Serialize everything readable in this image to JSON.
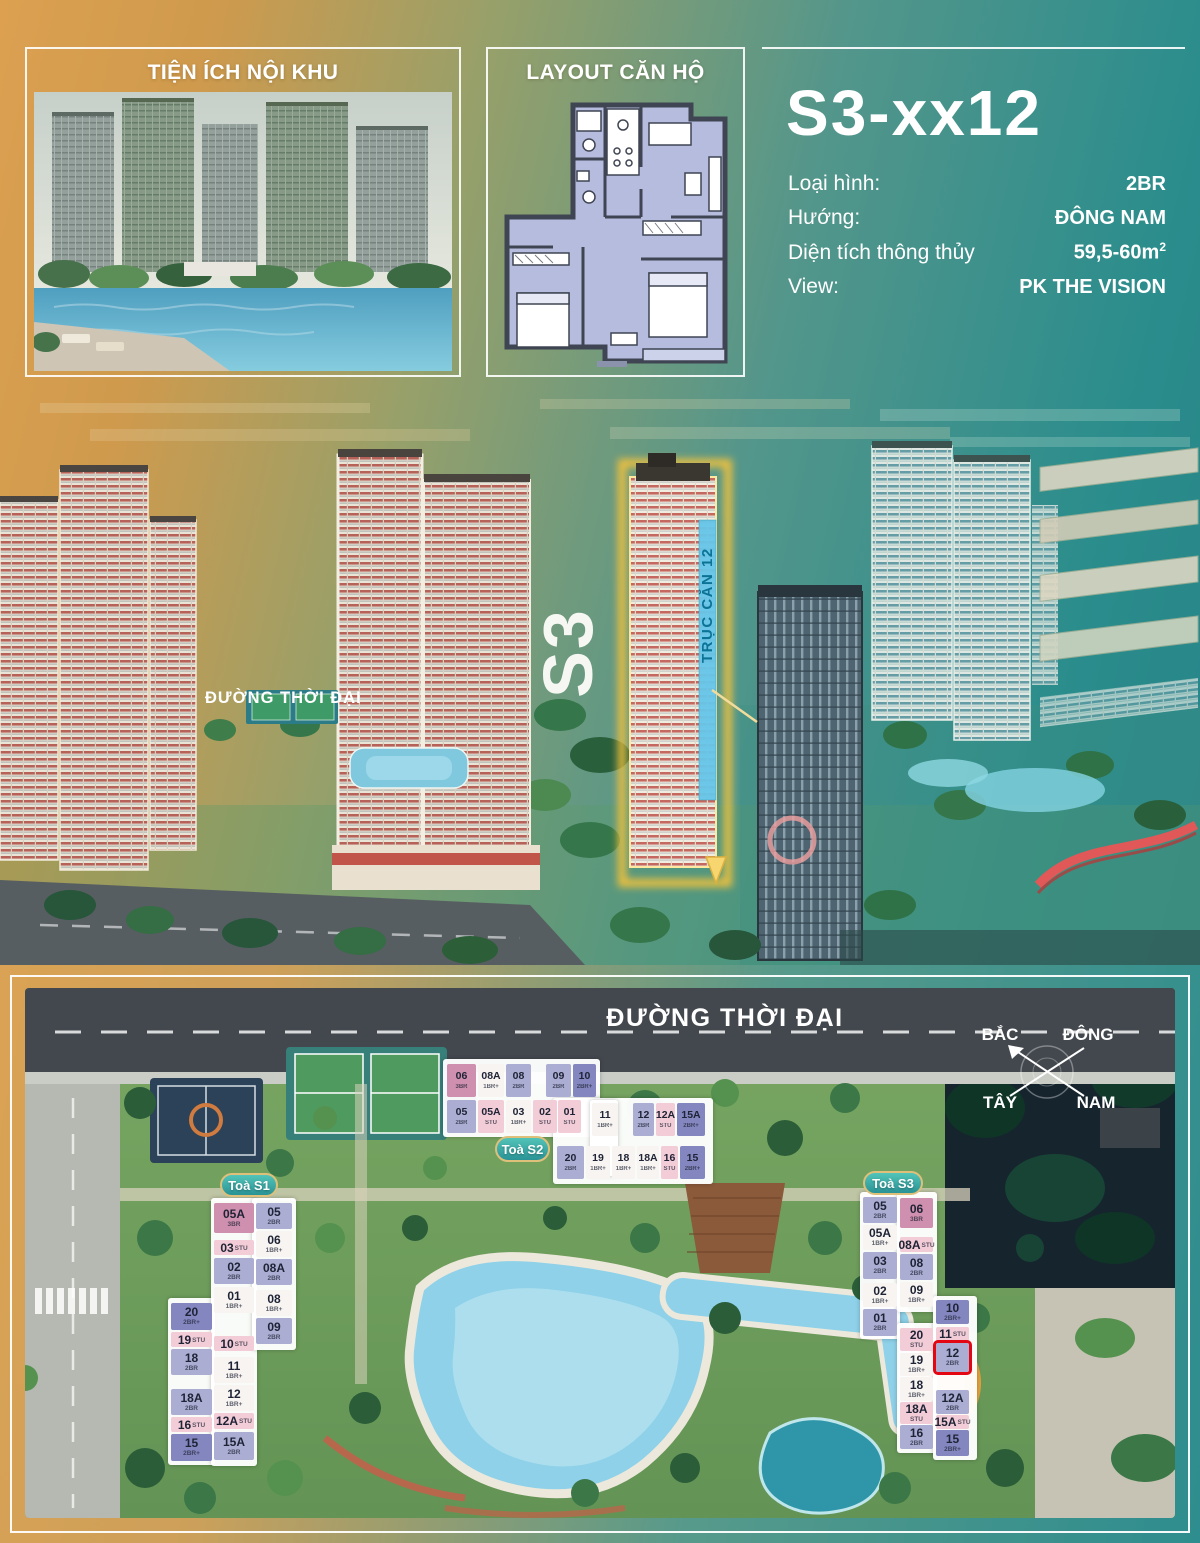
{
  "panels": {
    "amenities": {
      "title": "TIỆN ÍCH NỘI KHU"
    },
    "layout": {
      "title": "LAYOUT CĂN HỘ"
    },
    "unit": {
      "code": "S3-xx12",
      "specs": [
        {
          "label": "Loại hình:",
          "value": "2BR"
        },
        {
          "label": "Hướng:",
          "value": "ĐÔNG NAM"
        },
        {
          "label": "Diện tích thông thủy",
          "value": "59,5-60m",
          "sup": "2"
        },
        {
          "label": "View:",
          "value": "PK THE VISION"
        }
      ]
    }
  },
  "aerial": {
    "street_label": "ĐƯỜNG THỜI ĐẠI",
    "tower_label": "S3",
    "axis_label": "TRỤC CĂN 12"
  },
  "sitemap": {
    "street_label": "ĐƯỜNG THỜI ĐẠI",
    "compass": {
      "north": "BẮC",
      "east": "ĐÔNG",
      "west": "TÂY",
      "south": "NAM"
    },
    "highlight_unit": "S3-12",
    "legend_types": [
      "STU",
      "1BR+",
      "2BR",
      "2BR+",
      "3BR"
    ],
    "towers": [
      {
        "id": "S1",
        "label": "Toà S1",
        "pill": {
          "x": 195,
          "y": 185,
          "w": 58,
          "h": 24
        },
        "blocks": [
          [
            143,
            310,
            47,
            167
          ],
          [
            186,
            210,
            46,
            268
          ],
          [
            227,
            210,
            44,
            152
          ]
        ],
        "units": [
          {
            "n": "20",
            "t": "2BR+",
            "c": "bp",
            "x": 146,
            "y": 315,
            "w": 41,
            "h": 27
          },
          {
            "n": "19",
            "t": "STU",
            "c": "st",
            "x": 146,
            "y": 344,
            "w": 41,
            "h": 15,
            "s": 1
          },
          {
            "n": "18",
            "t": "2BR",
            "c": "b2",
            "x": 146,
            "y": 361,
            "w": 41,
            "h": 26
          },
          {
            "n": "18A",
            "t": "2BR",
            "c": "b2",
            "x": 146,
            "y": 401,
            "w": 41,
            "h": 26
          },
          {
            "n": "16",
            "t": "STU",
            "c": "st",
            "x": 146,
            "y": 429,
            "w": 41,
            "h": 15,
            "s": 1
          },
          {
            "n": "15",
            "t": "2BR+",
            "c": "bp",
            "x": 146,
            "y": 446,
            "w": 41,
            "h": 27
          },
          {
            "n": "05A",
            "t": "3BR",
            "c": "p3",
            "x": 189,
            "y": 215,
            "w": 40,
            "h": 30
          },
          {
            "n": "03",
            "t": "STU",
            "c": "st",
            "x": 189,
            "y": 252,
            "w": 40,
            "h": 15,
            "s": 1
          },
          {
            "n": "02",
            "t": "2BR",
            "c": "b2",
            "x": 189,
            "y": 270,
            "w": 40,
            "h": 26
          },
          {
            "n": "01",
            "t": "1BR+",
            "c": "b1",
            "x": 189,
            "y": 299,
            "w": 40,
            "h": 26
          },
          {
            "n": "10",
            "t": "STU",
            "c": "st",
            "x": 189,
            "y": 348,
            "w": 40,
            "h": 15,
            "s": 1
          },
          {
            "n": "11",
            "t": "1BR+",
            "c": "b1",
            "x": 189,
            "y": 369,
            "w": 40,
            "h": 26
          },
          {
            "n": "12",
            "t": "1BR+",
            "c": "b1",
            "x": 189,
            "y": 397,
            "w": 40,
            "h": 26
          },
          {
            "n": "12A",
            "t": "STU",
            "c": "st",
            "x": 189,
            "y": 425,
            "w": 40,
            "h": 16,
            "s": 1
          },
          {
            "n": "15A",
            "t": "2BR",
            "c": "b2",
            "x": 189,
            "y": 444,
            "w": 40,
            "h": 28
          },
          {
            "n": "05",
            "t": "2BR",
            "c": "b2",
            "x": 231,
            "y": 215,
            "w": 36,
            "h": 26
          },
          {
            "n": "06",
            "t": "1BR+",
            "c": "b1",
            "x": 231,
            "y": 243,
            "w": 36,
            "h": 26
          },
          {
            "n": "08A",
            "t": "2BR",
            "c": "b2",
            "x": 231,
            "y": 271,
            "w": 36,
            "h": 26
          },
          {
            "n": "08",
            "t": "1BR+",
            "c": "b1",
            "x": 231,
            "y": 302,
            "w": 36,
            "h": 26
          },
          {
            "n": "09",
            "t": "2BR",
            "c": "b2",
            "x": 231,
            "y": 330,
            "w": 36,
            "h": 26
          }
        ]
      },
      {
        "id": "S2",
        "label": "Toà S2",
        "pill": {
          "x": 470,
          "y": 148,
          "w": 55,
          "h": 26
        },
        "blocks": [
          [
            418,
            71,
            157,
            78
          ],
          [
            528,
            110,
            160,
            86
          ],
          [
            565,
            112,
            28,
            76
          ]
        ],
        "units": [
          {
            "n": "06",
            "t": "3BR",
            "c": "p3",
            "x": 422,
            "y": 76,
            "w": 29,
            "h": 33
          },
          {
            "n": "08A",
            "t": "1BR+",
            "c": "b1",
            "x": 453,
            "y": 76,
            "w": 26,
            "h": 33
          },
          {
            "n": "08",
            "t": "2BR",
            "c": "b2",
            "x": 481,
            "y": 76,
            "w": 25,
            "h": 33
          },
          {
            "n": "09",
            "t": "2BR",
            "c": "b2",
            "x": 521,
            "y": 76,
            "w": 25,
            "h": 33
          },
          {
            "n": "10",
            "t": "2BR+",
            "c": "bp",
            "x": 548,
            "y": 76,
            "w": 23,
            "h": 33
          },
          {
            "n": "05",
            "t": "2BR",
            "c": "b2",
            "x": 422,
            "y": 112,
            "w": 29,
            "h": 33
          },
          {
            "n": "05A",
            "t": "STU",
            "c": "st",
            "x": 453,
            "y": 112,
            "w": 26,
            "h": 33
          },
          {
            "n": "03",
            "t": "1BR+",
            "c": "b1",
            "x": 481,
            "y": 112,
            "w": 25,
            "h": 33
          },
          {
            "n": "02",
            "t": "STU",
            "c": "st",
            "x": 508,
            "y": 112,
            "w": 24,
            "h": 33
          },
          {
            "n": "01",
            "t": "STU",
            "c": "st",
            "x": 533,
            "y": 112,
            "w": 23,
            "h": 33
          },
          {
            "n": "11",
            "t": "1BR+",
            "c": "b1",
            "x": 567,
            "y": 115,
            "w": 26,
            "h": 33
          },
          {
            "n": "12",
            "t": "2BR",
            "c": "b2",
            "x": 608,
            "y": 115,
            "w": 21,
            "h": 33
          },
          {
            "n": "12A",
            "t": "STU",
            "c": "st",
            "x": 631,
            "y": 115,
            "w": 19,
            "h": 33
          },
          {
            "n": "15A",
            "t": "2BR+",
            "c": "bp",
            "x": 652,
            "y": 115,
            "w": 28,
            "h": 33
          },
          {
            "n": "20",
            "t": "2BR",
            "c": "b2",
            "x": 532,
            "y": 158,
            "w": 27,
            "h": 33
          },
          {
            "n": "19",
            "t": "1BR+",
            "c": "b1",
            "x": 561,
            "y": 158,
            "w": 24,
            "h": 33
          },
          {
            "n": "18",
            "t": "1BR+",
            "c": "b1",
            "x": 587,
            "y": 158,
            "w": 23,
            "h": 33
          },
          {
            "n": "18A",
            "t": "1BR+",
            "c": "b1",
            "x": 612,
            "y": 158,
            "w": 22,
            "h": 33
          },
          {
            "n": "16",
            "t": "STU",
            "c": "st",
            "x": 636,
            "y": 158,
            "w": 17,
            "h": 33
          },
          {
            "n": "15",
            "t": "2BR+",
            "c": "bp",
            "x": 655,
            "y": 158,
            "w": 25,
            "h": 33
          }
        ]
      },
      {
        "id": "S3",
        "label": "Toà S3",
        "pill": {
          "x": 838,
          "y": 183,
          "w": 60,
          "h": 24
        },
        "blocks": [
          [
            835,
            204,
            40,
            147
          ],
          [
            872,
            204,
            40,
            120
          ],
          [
            872,
            335,
            40,
            130
          ],
          [
            908,
            308,
            44,
            164
          ]
        ],
        "units": [
          {
            "n": "05",
            "t": "2BR",
            "c": "b2",
            "x": 838,
            "y": 209,
            "w": 34,
            "h": 26
          },
          {
            "n": "05A",
            "t": "1BR+",
            "c": "b1",
            "x": 838,
            "y": 237,
            "w": 34,
            "h": 25
          },
          {
            "n": "03",
            "t": "2BR",
            "c": "b2",
            "x": 838,
            "y": 264,
            "w": 34,
            "h": 27
          },
          {
            "n": "02",
            "t": "1BR+",
            "c": "b1",
            "x": 838,
            "y": 295,
            "w": 34,
            "h": 24
          },
          {
            "n": "01",
            "t": "2BR",
            "c": "b2",
            "x": 838,
            "y": 321,
            "w": 34,
            "h": 27
          },
          {
            "n": "06",
            "t": "3BR",
            "c": "p3",
            "x": 875,
            "y": 210,
            "w": 33,
            "h": 30
          },
          {
            "n": "08A",
            "t": "STU",
            "c": "st",
            "x": 875,
            "y": 249,
            "w": 33,
            "h": 15,
            "s": 1
          },
          {
            "n": "08",
            "t": "2BR",
            "c": "b2",
            "x": 875,
            "y": 266,
            "w": 33,
            "h": 26
          },
          {
            "n": "09",
            "t": "1BR+",
            "c": "b1",
            "x": 875,
            "y": 294,
            "w": 33,
            "h": 25
          },
          {
            "n": "20",
            "t": "STU",
            "c": "st",
            "x": 875,
            "y": 340,
            "w": 33,
            "h": 23
          },
          {
            "n": "19",
            "t": "1BR+",
            "c": "b1",
            "x": 875,
            "y": 365,
            "w": 33,
            "h": 23
          },
          {
            "n": "18",
            "t": "1BR+",
            "c": "b1",
            "x": 875,
            "y": 389,
            "w": 33,
            "h": 24
          },
          {
            "n": "18A",
            "t": "STU",
            "c": "st",
            "x": 875,
            "y": 414,
            "w": 33,
            "h": 22
          },
          {
            "n": "16",
            "t": "2BR",
            "c": "b2",
            "x": 875,
            "y": 437,
            "w": 33,
            "h": 24
          },
          {
            "n": "10",
            "t": "2BR+",
            "c": "bp",
            "x": 911,
            "y": 312,
            "w": 33,
            "h": 24
          },
          {
            "n": "11",
            "t": "STU",
            "c": "st",
            "x": 911,
            "y": 339,
            "w": 33,
            "h": 14,
            "s": 1
          },
          {
            "n": "12",
            "t": "2BR",
            "c": "b2",
            "x": 911,
            "y": 355,
            "w": 33,
            "h": 29,
            "hl": 1
          },
          {
            "n": "12A",
            "t": "2BR",
            "c": "b2",
            "x": 911,
            "y": 402,
            "w": 33,
            "h": 24
          },
          {
            "n": "15A",
            "t": "STU",
            "c": "st",
            "x": 911,
            "y": 427,
            "w": 33,
            "h": 14,
            "s": 1
          },
          {
            "n": "15",
            "t": "2BR+",
            "c": "bp",
            "x": 911,
            "y": 442,
            "w": 33,
            "h": 26
          }
        ]
      }
    ]
  },
  "colors": {
    "accent_gold": "#F6C945",
    "highlight_red": "#E30613",
    "pill_teal": "#2F9A99",
    "unit_types": {
      "3BR": "#CF8FAE",
      "STU": "#F2CCD6",
      "2BR": "#ABADD2",
      "1BR+": "#F7F4F1",
      "2BR+": "#8487BF"
    }
  }
}
